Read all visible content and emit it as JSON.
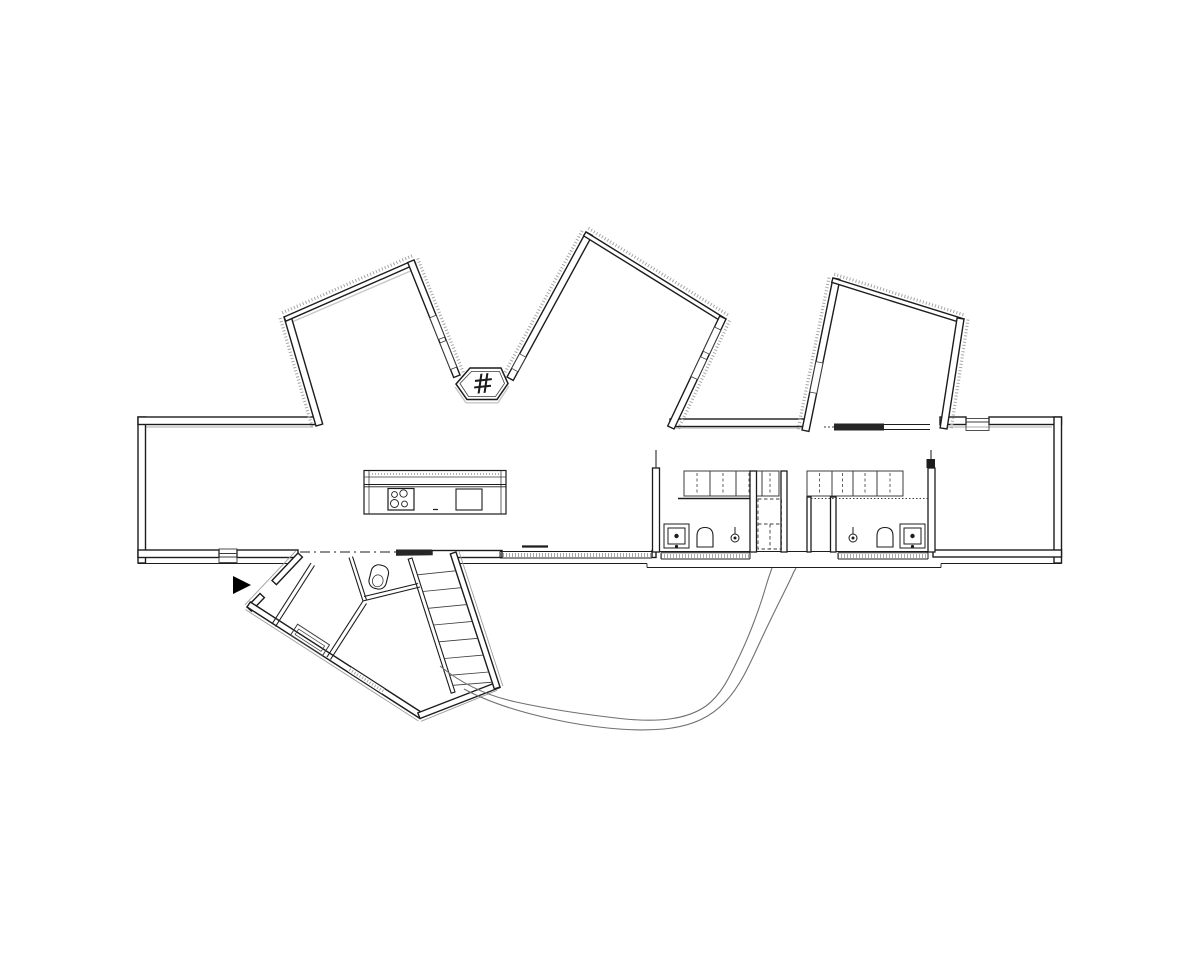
{
  "canvas": {
    "width": 1200,
    "height": 960,
    "background": "#ffffff"
  },
  "palette": {
    "wall_line": "#1c1c1c",
    "thin_line": "#3c3c3c",
    "hatch": "#a6a6a6",
    "shadow": "#c7c7c7",
    "door_bar": "#262626",
    "path_line": "#707070"
  },
  "fireplace": {
    "symbol": "#"
  },
  "plan": {
    "type": "architectural-floor-plan",
    "wings": [
      "north-wing-left",
      "north-wing-middle",
      "north-wing-right",
      "southwest-entry-wing"
    ],
    "band_rooms": [
      "living-area",
      "kitchen",
      "bedroom-1",
      "bathroom-1",
      "closet",
      "bedroom-2",
      "bathroom-2",
      "master-room"
    ],
    "fixtures": [
      "kitchen-island",
      "stove",
      "kitchen-sink",
      "fireplace-hex",
      "wardrobe-run-1",
      "wardrobe-run-2",
      "bath1-sink",
      "bath1-toilet",
      "bath1-shower",
      "bath2-shower",
      "bath2-toilet",
      "bath2-sink",
      "entry-toilet",
      "stairs",
      "sliding-door-bars",
      "entrance-arrow",
      "garden-path"
    ]
  }
}
